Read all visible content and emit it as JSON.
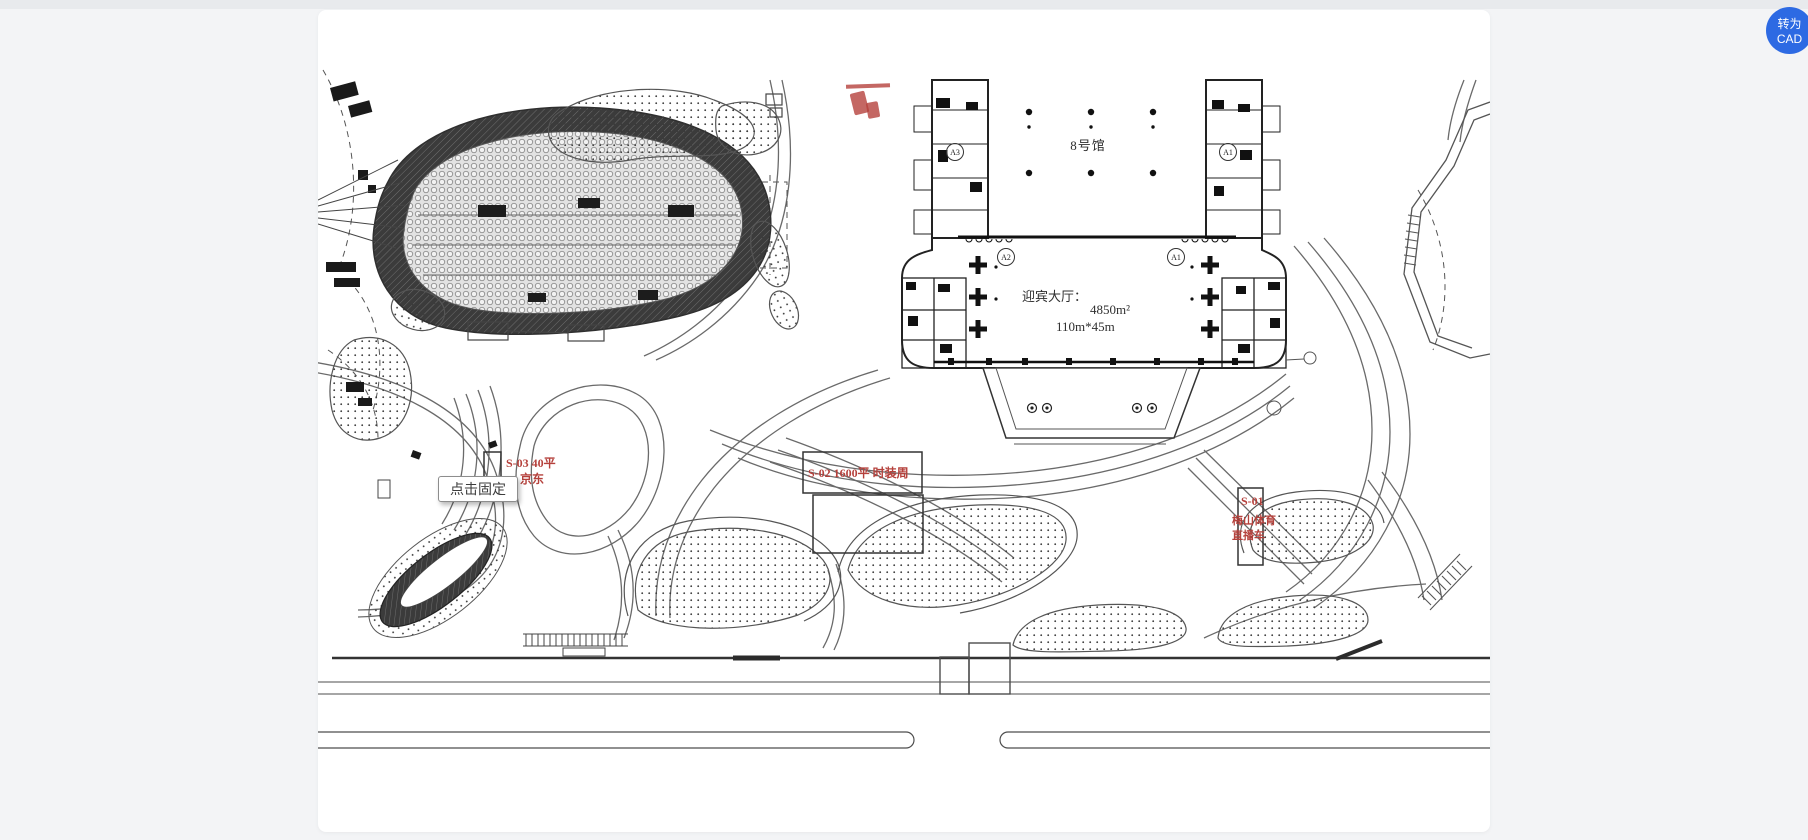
{
  "ui": {
    "convert_button_label": "转为CAD",
    "tooltip_text": "点击固定"
  },
  "plan": {
    "hall_label": "8号馆",
    "lobby_title": "迎宾大厅：",
    "lobby_area": "4850m²",
    "lobby_dimensions": "110m*45m",
    "grid_bubbles": {
      "top_left": "A3",
      "top_right": "A1",
      "lobby_left": "A2",
      "lobby_right": "A1"
    },
    "booths": {
      "s03_label": "S-03  40平",
      "s03_tenant": "京东",
      "s02_label": "S-02  1600平   时装周",
      "s01_id": "S-01",
      "s01_line1": "梅山体育",
      "s01_line2": "直播车"
    }
  },
  "colors": {
    "accent_blue": "#2d6ae3",
    "annotation_red": "#b5413c",
    "canvas_white": "#ffffff",
    "page_gray": "#f3f4f6",
    "line_dark": "#2f2f2f"
  }
}
